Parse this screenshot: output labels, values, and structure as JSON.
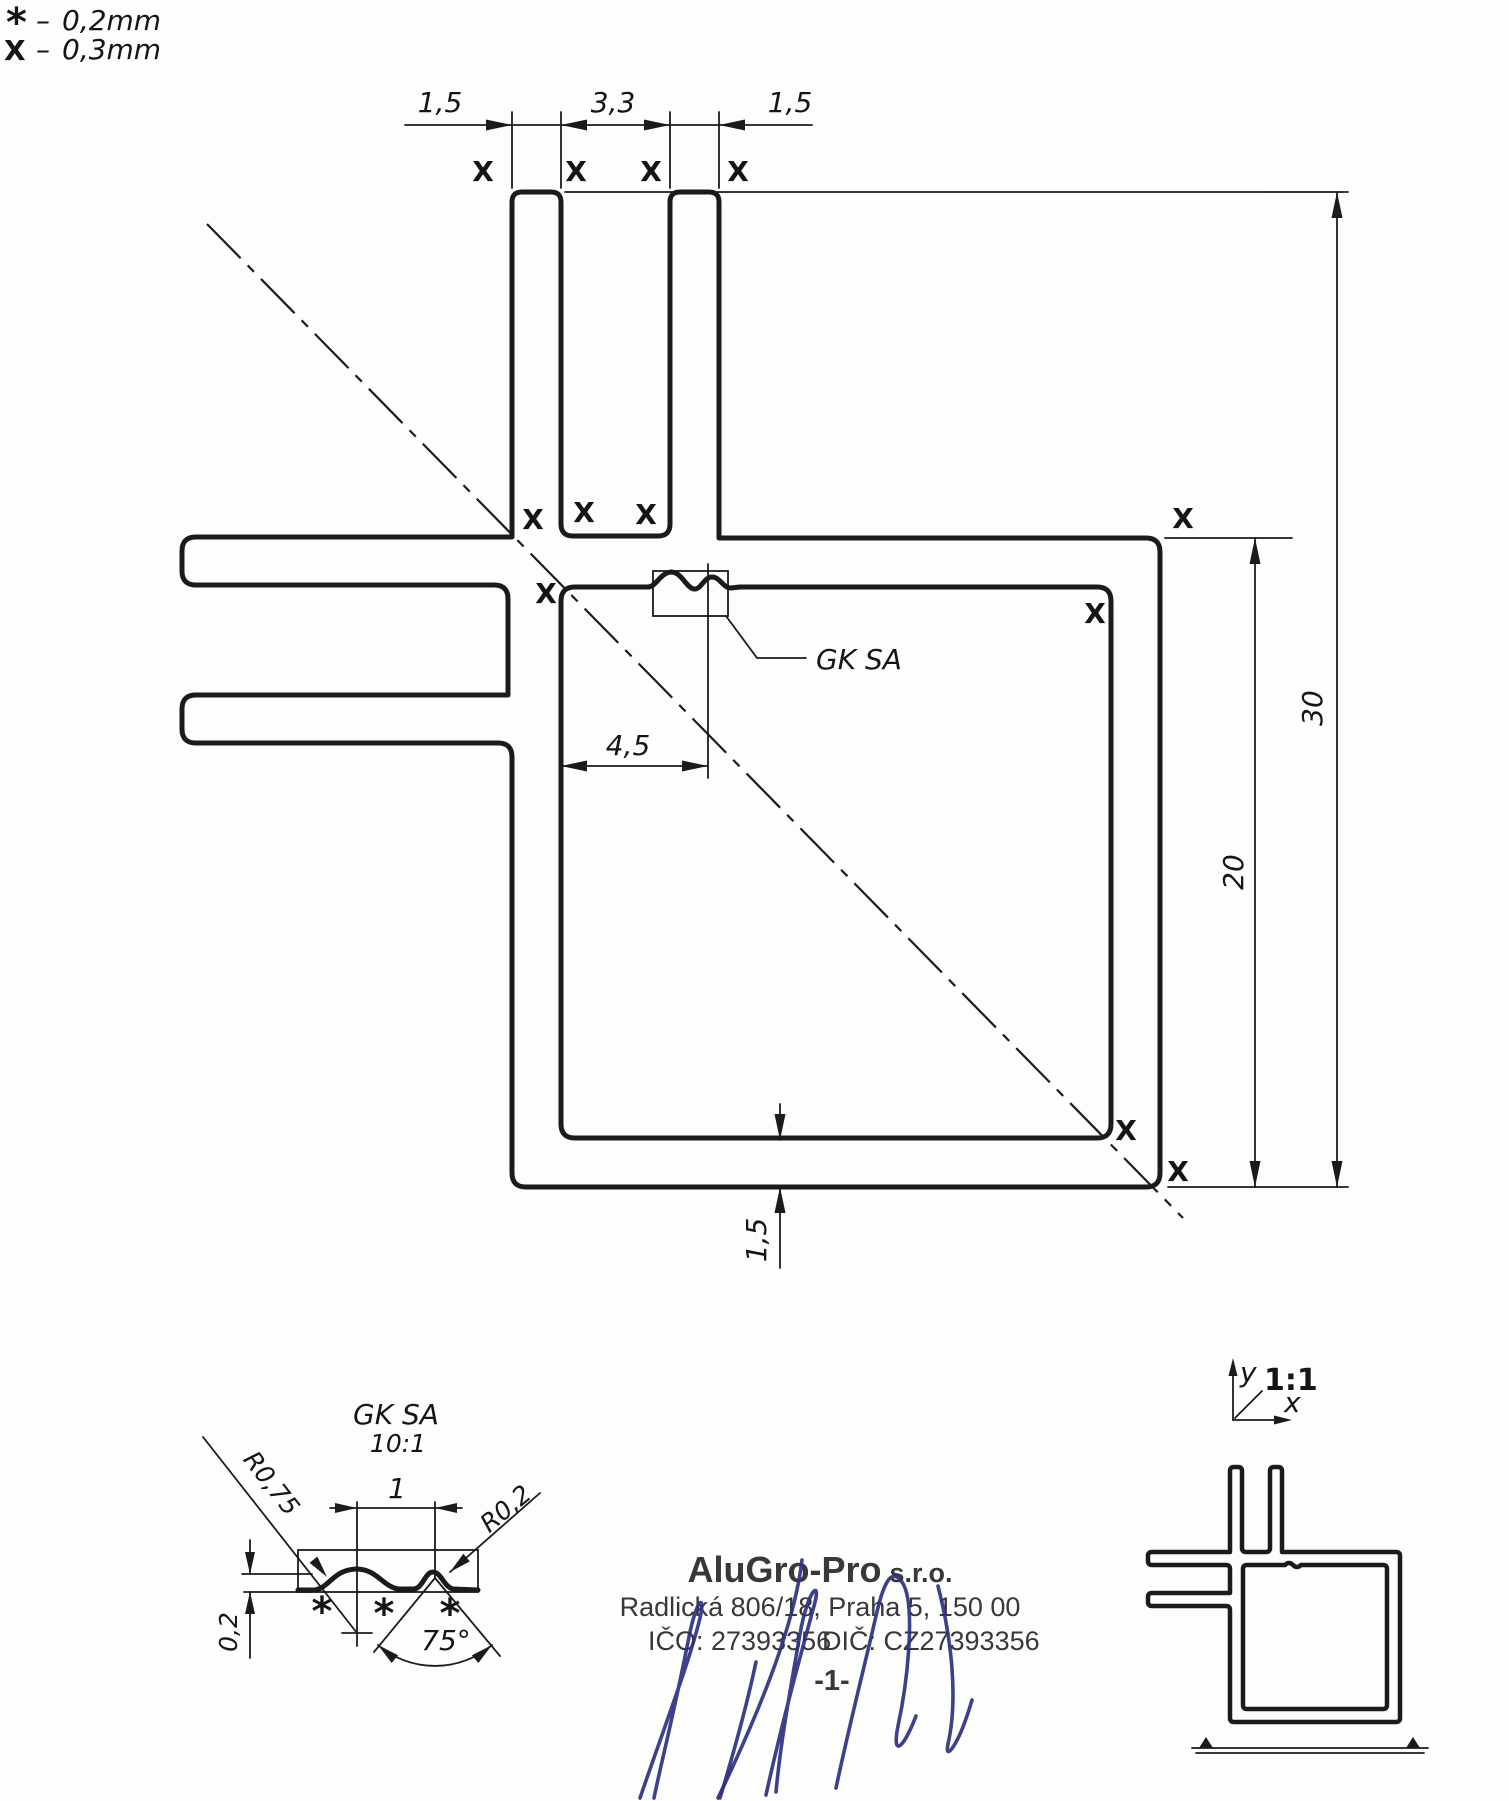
{
  "legend": {
    "rows": [
      {
        "symbol": "*",
        "separator": "–",
        "value": "0,2mm"
      },
      {
        "symbol": "X",
        "separator": "–",
        "value": "0,3mm"
      }
    ]
  },
  "dims": {
    "top_wall_left": "1,5",
    "top_groove": "3,3",
    "top_wall_right": "1,5",
    "body_height": "20",
    "total_height": "30",
    "feature_offset": "4,5",
    "bottom_wall": "1,5"
  },
  "marks": {
    "surface": "X",
    "tolerance_star": "*"
  },
  "callout": {
    "label": "GK SA"
  },
  "detail": {
    "title": "GK SA",
    "scale": "10:1",
    "r_left": "R0,75",
    "pitch": "1",
    "r_right": "R0,2",
    "depth": "0,2",
    "angle": "75°"
  },
  "axis": {
    "y_label": "y",
    "x_label": "x",
    "scale": "1:1"
  },
  "title_block": {
    "company": "AluGro-Pro",
    "legal": "s.r.o.",
    "address": "Radlická 806/18, Praha 5, 150 00",
    "ico": "IČO: 27393356",
    "dic": "DIČ: CZ27393356",
    "page": "-1-"
  }
}
